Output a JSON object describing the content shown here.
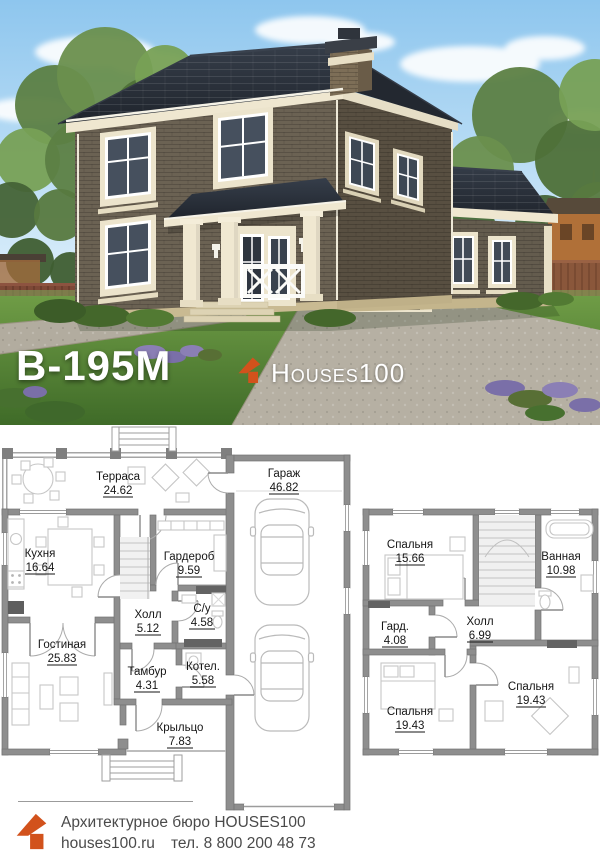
{
  "photo": {
    "model_label": "В-195М",
    "brand_text": "Houses100",
    "brand_icon": "house-arrow-icon"
  },
  "plans": {
    "first": {
      "rooms": [
        {
          "name": "Терраса",
          "area": "24.62"
        },
        {
          "name": "Гараж",
          "area": "46.82"
        },
        {
          "name": "Кухня",
          "area": "16.64"
        },
        {
          "name": "Гардероб",
          "area": "9.59"
        },
        {
          "name": "Холл",
          "area": "5.12"
        },
        {
          "name": "С/у",
          "area": "4.58"
        },
        {
          "name": "Гостиная",
          "area": "25.83"
        },
        {
          "name": "Тамбур",
          "area": "4.31"
        },
        {
          "name": "Котел.",
          "area": "5.58"
        },
        {
          "name": "Крыльцо",
          "area": "7.83"
        }
      ]
    },
    "second": {
      "rooms": [
        {
          "name": "Спальня",
          "area": "15.66"
        },
        {
          "name": "Ванная",
          "area": "10.98"
        },
        {
          "name": "Гард.",
          "area": "4.08"
        },
        {
          "name": "Холл",
          "area": "6.99"
        },
        {
          "name": "Спальня",
          "area": "19.43"
        },
        {
          "name": "Спальня",
          "area": "19.43"
        }
      ]
    }
  },
  "footer": {
    "line1": "Архитектурное бюро HOUSES100",
    "site": "houses100.ru",
    "phone": "тел. 8 800 200 48 73"
  },
  "colors": {
    "accent_orange": "#d2521c",
    "roof": "#2b313b",
    "brick_front": "#6b6253",
    "trim_cream": "#ece4cc"
  }
}
